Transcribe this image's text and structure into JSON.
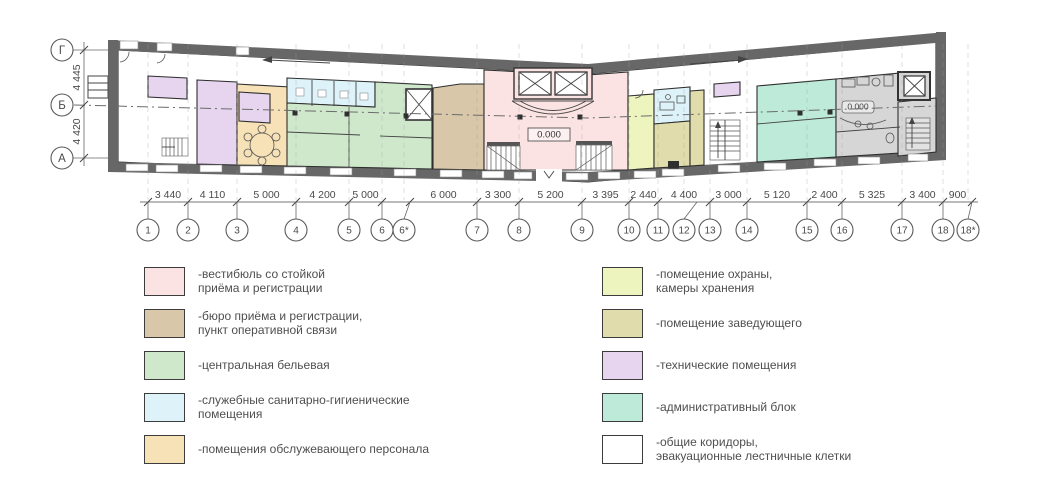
{
  "plan": {
    "row_axes": [
      "Г",
      "Б",
      "А"
    ],
    "row_dims": [
      "4 445",
      "4 420"
    ],
    "col_axes": [
      "1",
      "2",
      "3",
      "4",
      "5",
      "6",
      "6*",
      "7",
      "8",
      "9",
      "10",
      "11",
      "12",
      "13",
      "14",
      "15",
      "16",
      "17",
      "18",
      "18*"
    ],
    "col_dims": [
      "3 440",
      "4 110",
      "5 000",
      "4 200",
      "5 000",
      "6 000",
      "3 300",
      "5 200",
      "3 395",
      "2 440",
      "4 400",
      "3 000",
      "5 120",
      "2 400",
      "5 325",
      "3 400",
      "900"
    ],
    "level_marks": [
      "0.000",
      "0.000"
    ]
  },
  "legend": {
    "left": [
      {
        "color": "#fbe3e3",
        "label": "-вестибюль со стойкой\nприёма и регистрации"
      },
      {
        "color": "#d8c7a8",
        "label": "-бюро приёма и регистрации,\nпункт оперативной связи"
      },
      {
        "color": "#cfe8cc",
        "label": "-центральная бельевая"
      },
      {
        "color": "#def3f9",
        "label": "-служебные санитарно-гигиенические\nпомещения"
      },
      {
        "color": "#f6e2b6",
        "label": "-помещения обслужевающего персонала"
      }
    ],
    "right": [
      {
        "color": "#eef4bd",
        "label": "-помещение охраны,\nкамеры хранения"
      },
      {
        "color": "#e0dcab",
        "label": "-помещение заведующего"
      },
      {
        "color": "#e7d5ef",
        "label": "-технические помещения"
      },
      {
        "color": "#bdead9",
        "label": "-административный блок"
      },
      {
        "color": "#ffffff",
        "label": "-общие коридоры,\nэвакуационные лестничные клетки"
      }
    ]
  }
}
